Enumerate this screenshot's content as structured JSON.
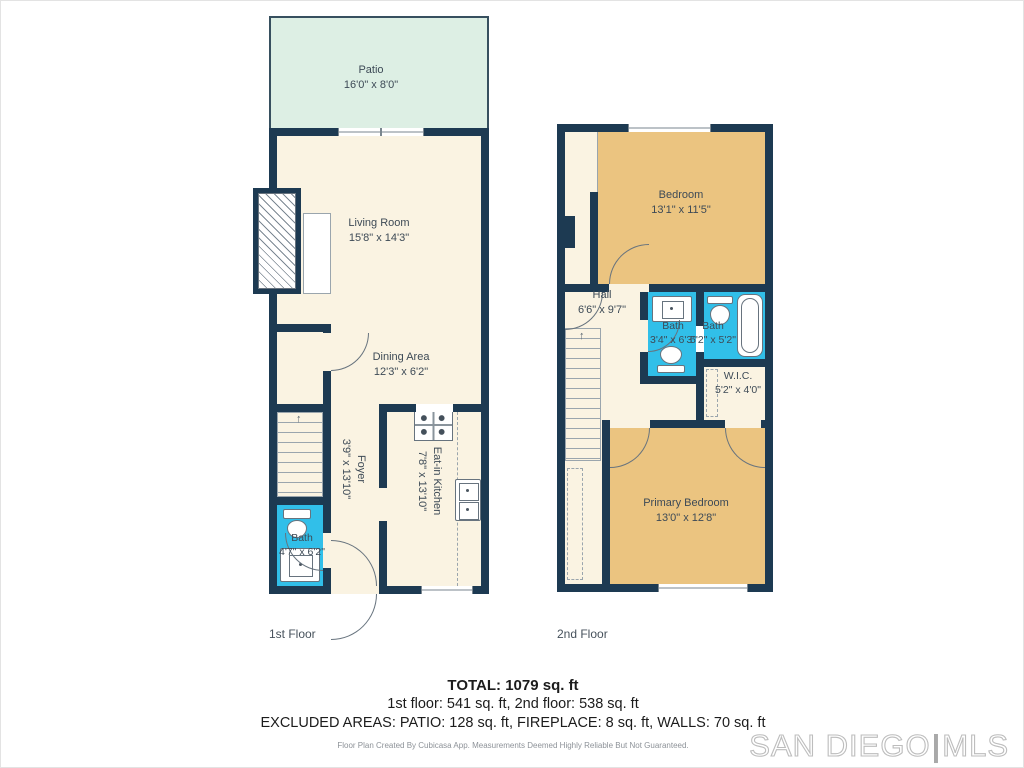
{
  "colors": {
    "wall": "#1d3a52",
    "room_cream": "#faf3e2",
    "bedroom_tan": "#ebc480",
    "bath_cyan": "#31bfe9",
    "patio_green": "#ddefe4",
    "label_text": "#3d4a56",
    "watermark_gray": "#bdbdbd"
  },
  "floor1": {
    "caption": "1st Floor",
    "patio": {
      "name": "Patio",
      "dims": "16'0\" x 8'0\""
    },
    "living": {
      "name": "Living Room",
      "dims": "15'8\" x 14'3\""
    },
    "dining": {
      "name": "Dining Area",
      "dims": "12'3\" x 6'2\""
    },
    "foyer": {
      "name": "Foyer",
      "dims": "3'9\" x 13'10\""
    },
    "kitchen": {
      "name": "Eat-in Kitchen",
      "dims": "7'8\" x 13'10\""
    },
    "bath": {
      "name": "Bath",
      "dims": "4'7\" x 6'2\""
    }
  },
  "floor2": {
    "caption": "2nd Floor",
    "bedroom": {
      "name": "Bedroom",
      "dims": "13'1\" x 11'5\""
    },
    "hall": {
      "name": "Hall",
      "dims": "6'6\" x 9'7\""
    },
    "bath_left": {
      "name": "Bath",
      "dims": "3'4\" x 6'3\""
    },
    "bath_right": {
      "name": "Bath",
      "dims": "5'2\" x 5'2\""
    },
    "wic": {
      "name": "W.I.C.",
      "dims": "5'2\" x 4'0\""
    },
    "primary": {
      "name": "Primary Bedroom",
      "dims": "13'0\" x 12'8\""
    }
  },
  "footer": {
    "total": "TOTAL: 1079 sq. ft",
    "floors": "1st floor: 541 sq. ft, 2nd floor: 538 sq. ft",
    "excluded": "EXCLUDED AREAS: PATIO: 128 sq. ft, FIREPLACE: 8 sq. ft, WALLS: 70 sq. ft",
    "disclaimer": "Floor Plan Created By Cubicasa App. Measurements Deemed Highly Reliable But Not Guaranteed."
  },
  "watermark": {
    "left": "SAN DIEGO",
    "separator": "|",
    "right": "MLS"
  }
}
